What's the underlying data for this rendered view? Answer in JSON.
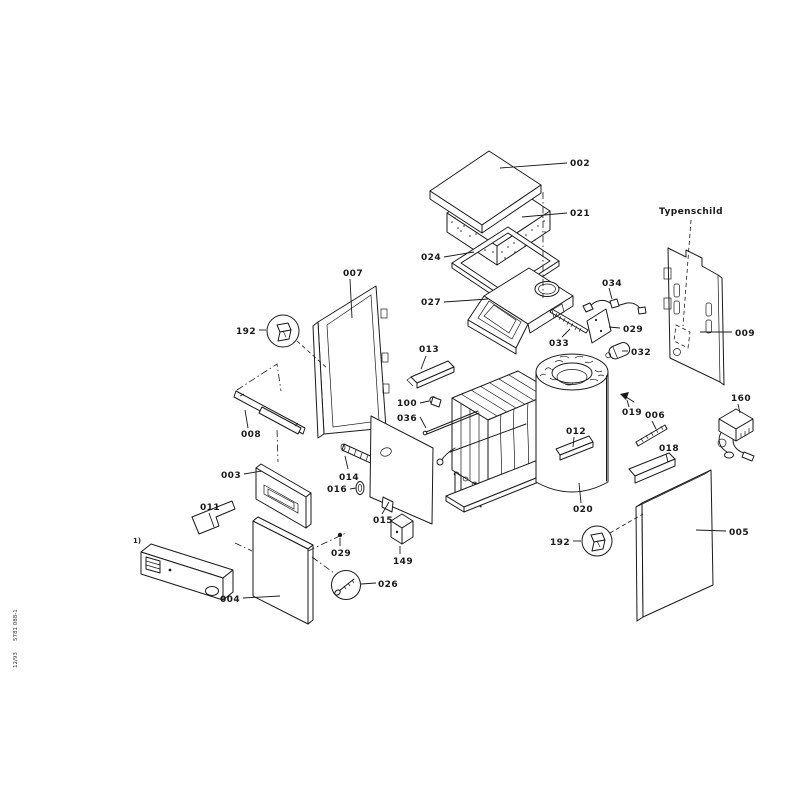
{
  "page": {
    "background": "#ffffff",
    "ink": "#1a1a1a"
  },
  "diagram": {
    "type": "exploded-parts-diagram",
    "subject": "boiler-assembly",
    "annotations": {
      "typenschild": "Typenschild",
      "footnote_marker": "1)",
      "doc_number": "5781 088-1",
      "doc_date": "12/93"
    },
    "labels": {
      "l002": "002",
      "l021": "021",
      "l024": "024",
      "l027": "027",
      "l033": "033",
      "l034": "034",
      "l029a": "029",
      "l032": "032",
      "l009": "009",
      "l007": "007",
      "l192a": "192",
      "l008": "008",
      "l003": "003",
      "l011": "011",
      "l004": "004",
      "l014": "014",
      "l016": "016",
      "l015": "015",
      "l029b": "029",
      "l149": "149",
      "l026": "026",
      "l013": "013",
      "l100": "100",
      "l036": "036",
      "l012": "012",
      "l020": "020",
      "l019": "019",
      "l006": "006",
      "l018": "018",
      "l160": "160",
      "l192b": "192",
      "l005": "005"
    }
  }
}
